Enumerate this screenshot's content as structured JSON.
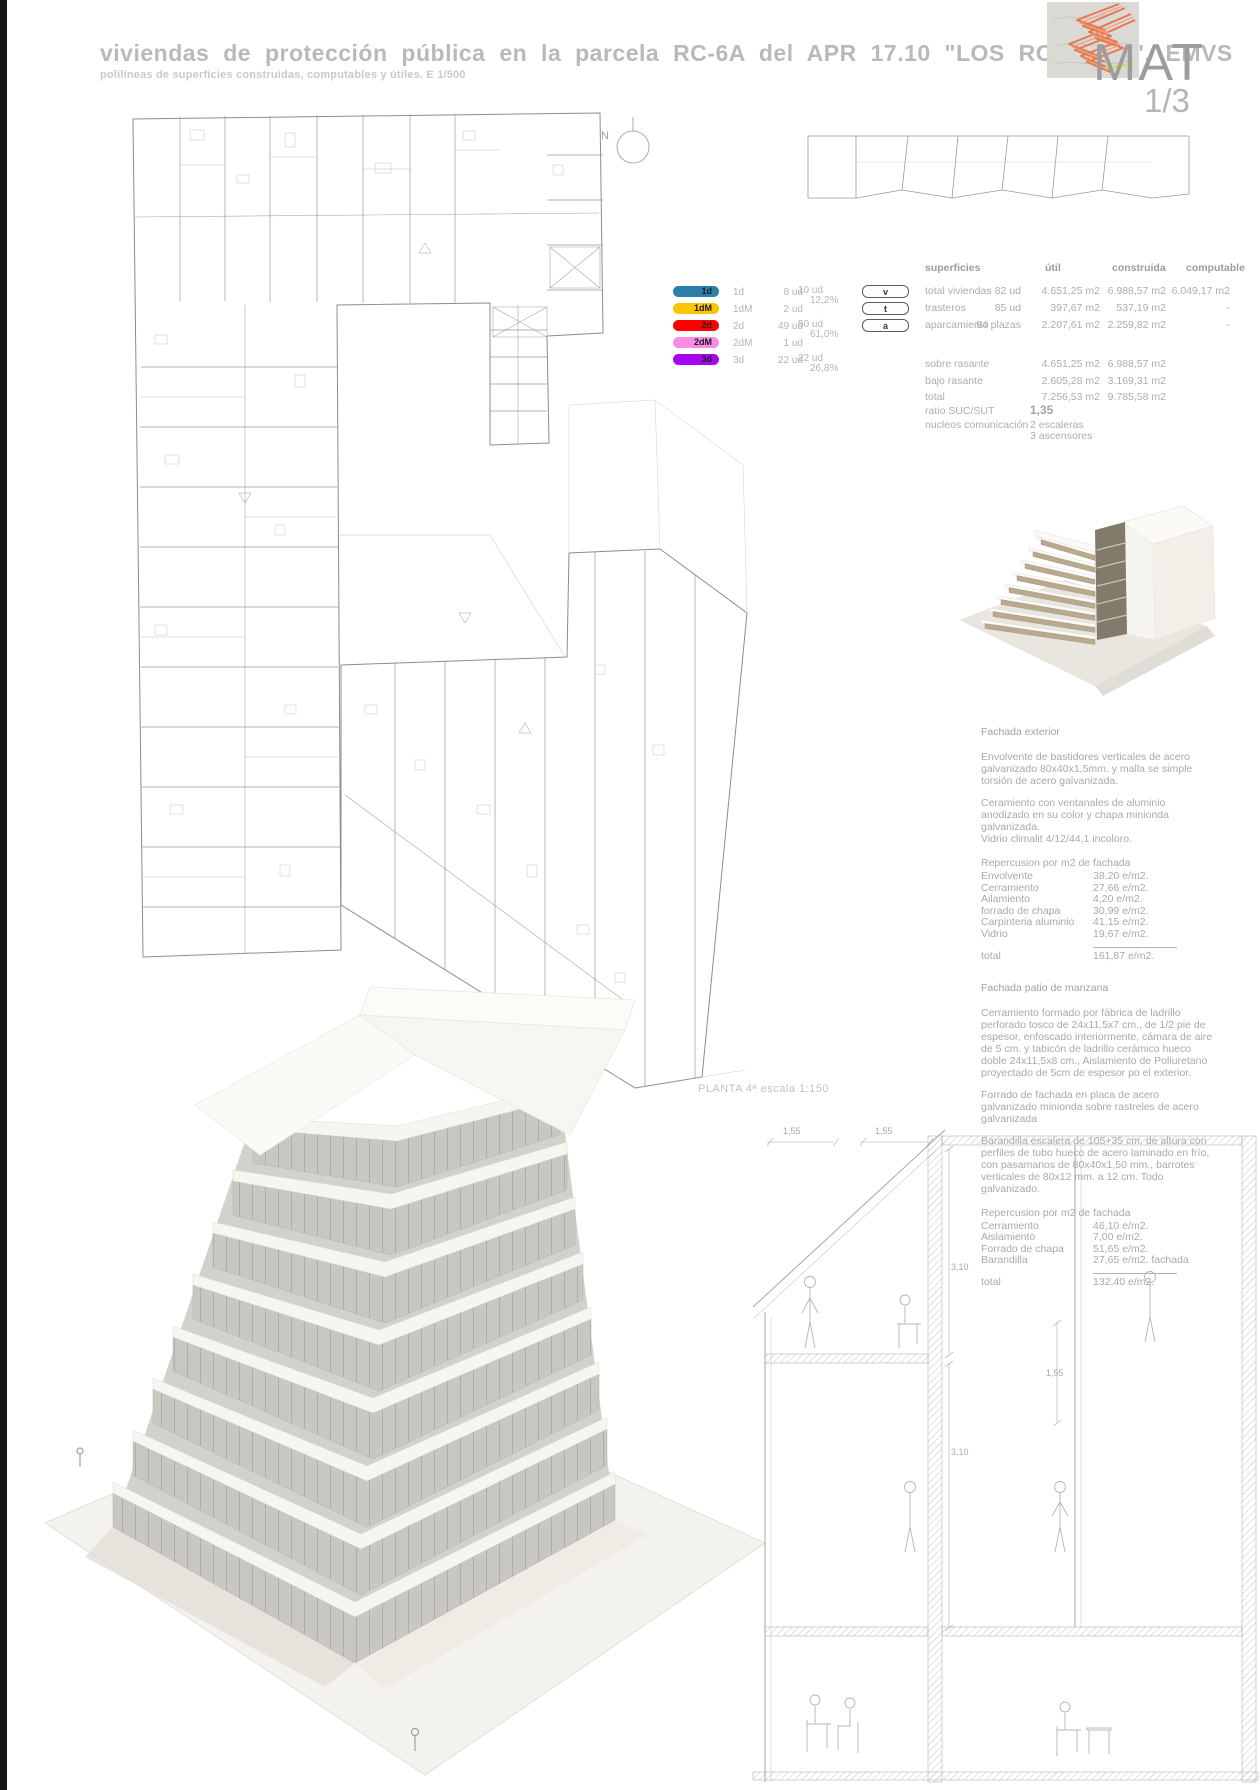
{
  "header": {
    "title": "viviendas de protección pública en la parcela RC-6A del APR 17.10 \"LOS ROSALES\". EMVS",
    "subtitle": "polilíneas de superficies construidas, computables y útiles. E 1/500",
    "sheet_code": "MAT",
    "sheet_number": "1/3"
  },
  "plan": {
    "north_label": "N",
    "caption": "PLANTA 4ª escala 1:150"
  },
  "legend": {
    "items": [
      {
        "code": "1d",
        "color": "#2b80a8",
        "units": "8 ud"
      },
      {
        "code": "1dM",
        "color": "#fdc400",
        "units": "2 ud"
      },
      {
        "code": "2d",
        "color": "#fe0000",
        "units": "49 ud"
      },
      {
        "code": "2dM",
        "color": "#fb8ce2",
        "units": "1 ud"
      },
      {
        "code": "3d",
        "color": "#a705ee",
        "units": "22 ud"
      }
    ],
    "groups": [
      {
        "total": "10 ud",
        "pct": "12,2%"
      },
      {
        "total": "50 ud",
        "pct": "61,0%"
      },
      {
        "total": "22 ud",
        "pct": "26,8%"
      }
    ]
  },
  "keys": {
    "v": "v",
    "t": "t",
    "a": "a"
  },
  "surfaces": {
    "col_label": "superficies",
    "col_util": "útil",
    "col_built": "construida",
    "col_comp": "computable",
    "rows": [
      {
        "label": "total viviendas",
        "qty": "82 ud",
        "util": "4.651,25 m2",
        "built": "6.988,57 m2",
        "comp": "6.049,17 m2"
      },
      {
        "label": "trasteros",
        "qty": "85 ud",
        "util": "397,67 m2",
        "built": "537,19 m2",
        "comp": "-"
      },
      {
        "label": "aparcamiento",
        "qty": "94 plazas",
        "util": "2.207,61 m2",
        "built": "2.259,82 m2",
        "comp": "-"
      }
    ],
    "summary": [
      {
        "label": "sobre rasante",
        "util": "4.651,25 m2",
        "built": "6.988,57 m2"
      },
      {
        "label": "bajo rasante",
        "util": "2.605,28 m2",
        "built": "3.169,31 m2"
      },
      {
        "label": "total",
        "util": "7.256,53 m2",
        "built": "9.785,58 m2"
      }
    ],
    "ratio_label": "ratio SUC/SUT",
    "ratio_value": "1,35",
    "cores_label": "nucleos comunicación",
    "cores_value1": "2 escaleras",
    "cores_value2": "3 ascensores"
  },
  "facade_exterior": {
    "title": "Fachada exterior",
    "p1": "Envolvente de bastidores verticales de acero galvanizado 80x40x1,5mm. y malla se simple torsión de acero galvanizada.",
    "p2": "Ceramiento con ventanales de aluminio anodizado en su color y chapa minionda galvanizada.",
    "p3": "Vidrio climalit 4/12/44,1 incoloro.",
    "costs_title": "Repercusion por m2 de fachada",
    "costs": [
      {
        "label": "Envolvente",
        "value": "38,20 e/m2."
      },
      {
        "label": "Cerramiento",
        "value": "27,66 e/m2."
      },
      {
        "label": "Ailamiento",
        "value": "4,20 e/m2."
      },
      {
        "label": "forrado de chapa",
        "value": "30,99 e/m2."
      },
      {
        "label": "Carpinteria aluminio",
        "value": "41,15 e/m2."
      },
      {
        "label": "Vidrio",
        "value": "19,67 e/m2."
      }
    ],
    "total_label": "total",
    "total_value": "161,87 e/m2."
  },
  "facade_patio": {
    "title": "Fachada patio de manzana",
    "p1": "Cerramiento formado por fábrica de ladrillo perforado tosco de 24x11,5x7 cm., de 1/2 pie de espesor, enfoscado interiormente, cámara de aire de 5 cm. y tabicón de ladrillo cerámico hueco doble 24x11,5x8 cm., Aislamiento de Poliuretano proyectado de 5cm de espesor po el exterior.",
    "p2": "Forrado de fachada en placa de acero galvanizado minionda sobre rastreles de acero galvanizada",
    "p3": "Barandilla escalera de 105+35 cm. de altura con perfiles de tubo hueco de acero laminado en frío, con pasamanos de 80x40x1,50 mm., barrotes verticales de 80x12 mm. a 12 cm. Todo galvanizado.",
    "costs_title": "Repercusion por m2 de fachada",
    "costs": [
      {
        "label": "Cerramiento",
        "value": "46,10 e/m2."
      },
      {
        "label": "Aislamiento",
        "value": "7,00 e/m2."
      },
      {
        "label": "Forrado de chapa",
        "value": "51,65 e/m2."
      },
      {
        "label": "Barandilla",
        "value": "27,65 e/m2. fachada"
      }
    ],
    "total_label": "total",
    "total_value": "132,40 e/m2."
  },
  "section": {
    "dims": [
      "1,55",
      "1,55",
      "3,10",
      "1,55",
      "3,10"
    ]
  }
}
